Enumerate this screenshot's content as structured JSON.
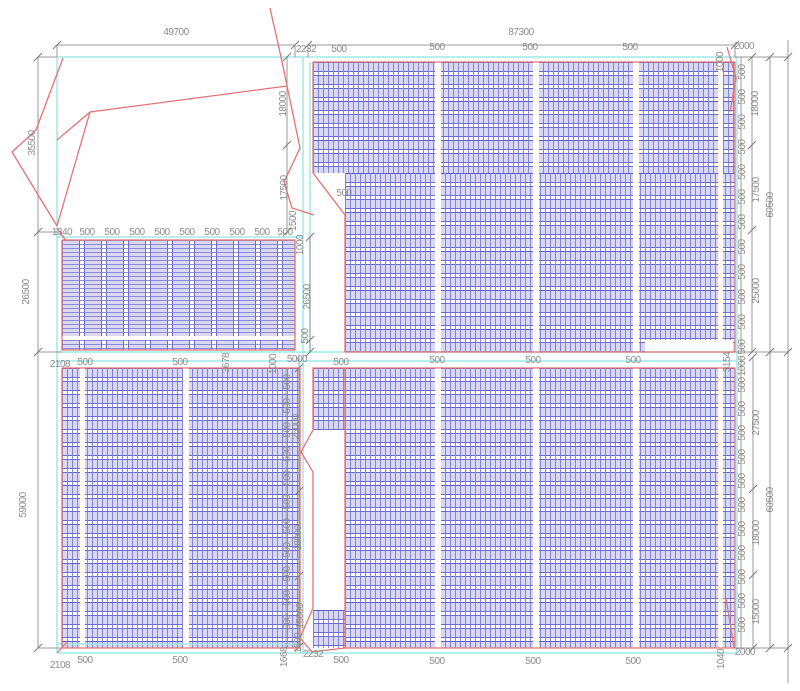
{
  "drawing": {
    "type": "cad-site-plan",
    "width": 800,
    "height": 691,
    "colors": {
      "panel_stripe": "#7676d2",
      "panel_fill": "#a8a8e5",
      "panel_line": "#6b6bce",
      "outline_red": "#e57373",
      "boundary_cyan": "#9fe8e8",
      "dimension_gray": "#9a9a9a",
      "tick_gray": "#7a7a7a",
      "label_gray": "#8c8c8c"
    },
    "blocks": [
      {
        "name": "array-top-right-upper",
        "x": 313,
        "y": 62,
        "w": 422,
        "h": 111,
        "pattern": "rows"
      },
      {
        "name": "array-top-right-lower",
        "x": 345,
        "y": 173,
        "w": 390,
        "h": 179,
        "pattern": "rows"
      },
      {
        "name": "array-mid-left",
        "x": 62,
        "y": 240,
        "w": 233,
        "h": 110,
        "pattern": "cols"
      },
      {
        "name": "array-bottom-left",
        "x": 62,
        "y": 368,
        "w": 238,
        "h": 280,
        "pattern": "rows"
      },
      {
        "name": "array-bottom-right",
        "x": 345,
        "y": 368,
        "w": 390,
        "h": 280,
        "pattern": "rows"
      },
      {
        "name": "array-bottom-right-left-strip-top",
        "x": 313,
        "y": 368,
        "w": 32,
        "h": 62,
        "pattern": "rows"
      },
      {
        "name": "array-bottom-right-left-strip-bottom",
        "x": 313,
        "y": 610,
        "w": 32,
        "h": 38,
        "pattern": "rows"
      }
    ],
    "white_patches": [
      {
        "x": 435,
        "y": 62,
        "w": 6,
        "h": 290
      },
      {
        "x": 533,
        "y": 62,
        "w": 6,
        "h": 290
      },
      {
        "x": 633,
        "y": 62,
        "w": 6,
        "h": 290
      },
      {
        "x": 718,
        "y": 62,
        "w": 5,
        "h": 290
      },
      {
        "x": 645,
        "y": 340,
        "w": 88,
        "h": 12
      },
      {
        "x": 62,
        "y": 336,
        "w": 233,
        "h": 4
      },
      {
        "x": 80,
        "y": 368,
        "w": 5,
        "h": 280
      },
      {
        "x": 183,
        "y": 368,
        "w": 6,
        "h": 280
      },
      {
        "x": 435,
        "y": 368,
        "w": 6,
        "h": 280
      },
      {
        "x": 533,
        "y": 368,
        "w": 6,
        "h": 280
      },
      {
        "x": 633,
        "y": 368,
        "w": 6,
        "h": 280
      },
      {
        "x": 718,
        "y": 368,
        "w": 5,
        "h": 280
      }
    ],
    "red_polylines": [
      [
        [
          313,
          62
        ],
        [
          735,
          62
        ],
        [
          735,
          352
        ],
        [
          345,
          352
        ],
        [
          345,
          215
        ],
        [
          313,
          173
        ],
        [
          313,
          62
        ]
      ],
      [
        [
          62,
          240
        ],
        [
          295,
          240
        ],
        [
          295,
          350
        ],
        [
          62,
          350
        ],
        [
          62,
          240
        ]
      ],
      [
        [
          62,
          368
        ],
        [
          300,
          368
        ],
        [
          300,
          648
        ],
        [
          62,
          648
        ],
        [
          62,
          368
        ]
      ],
      [
        [
          345,
          368
        ],
        [
          735,
          368
        ],
        [
          735,
          648
        ],
        [
          345,
          648
        ],
        [
          345,
          368
        ]
      ],
      [
        [
          345,
          368
        ],
        [
          313,
          368
        ],
        [
          313,
          430
        ],
        [
          301,
          452
        ],
        [
          313,
          472
        ],
        [
          313,
          608
        ],
        [
          300,
          638
        ],
        [
          312,
          652
        ],
        [
          345,
          648
        ]
      ],
      [
        [
          63,
          58
        ],
        [
          36,
          130
        ],
        [
          12,
          152
        ],
        [
          57,
          226
        ]
      ],
      [
        [
          287,
          86
        ],
        [
          90,
          112
        ],
        [
          57,
          140
        ]
      ],
      [
        [
          90,
          112
        ],
        [
          57,
          226
        ]
      ],
      [
        [
          270,
          8
        ],
        [
          281,
          57
        ],
        [
          300,
          148
        ],
        [
          284,
          182
        ],
        [
          292,
          208
        ],
        [
          314,
          215
        ]
      ],
      [
        [
          727,
          47
        ],
        [
          736,
          78
        ],
        [
          730,
          112
        ]
      ],
      [
        [
          726,
          598
        ],
        [
          734,
          648
        ]
      ],
      [
        [
          57,
          228
        ],
        [
          66,
          241
        ]
      ],
      [
        [
          57,
          653
        ],
        [
          67,
          642
        ]
      ]
    ],
    "cyan_lines": [
      [
        57,
        57,
        737,
        57
      ],
      [
        57,
        653,
        737,
        653
      ],
      [
        57,
        57,
        57,
        653
      ],
      [
        737,
        57,
        737,
        653
      ],
      [
        303,
        57,
        303,
        653
      ],
      [
        310,
        62,
        310,
        352
      ],
      [
        57,
        237,
        303,
        237
      ],
      [
        57,
        352,
        737,
        352
      ],
      [
        57,
        361,
        737,
        361
      ],
      [
        57,
        644,
        303,
        644
      ]
    ],
    "dim_lines": [
      [
        57,
        45,
        295,
        45
      ],
      [
        308,
        45,
        735,
        45
      ],
      [
        38,
        57,
        38,
        648
      ],
      [
        287,
        57,
        287,
        232
      ],
      [
        310,
        237,
        310,
        352
      ],
      [
        286,
        368,
        286,
        648
      ],
      [
        299,
        357,
        299,
        648
      ],
      [
        741,
        57,
        741,
        352
      ],
      [
        741,
        357,
        741,
        648
      ],
      [
        752,
        57,
        752,
        352
      ],
      [
        753,
        357,
        753,
        648
      ],
      [
        770,
        57,
        770,
        648
      ],
      [
        788,
        40,
        788,
        683
      ],
      [
        57,
        45,
        57,
        57
      ],
      [
        295,
        45,
        295,
        57
      ],
      [
        308,
        45,
        308,
        57
      ],
      [
        735,
        45,
        735,
        57
      ],
      [
        38,
        57,
        57,
        57
      ],
      [
        38,
        232,
        62,
        232
      ],
      [
        38,
        352,
        62,
        352
      ],
      [
        38,
        648,
        62,
        648
      ],
      [
        735,
        57,
        788,
        57
      ],
      [
        735,
        352,
        788,
        352
      ],
      [
        735,
        648,
        788,
        648
      ]
    ],
    "ticks": [
      [
        57,
        45
      ],
      [
        295,
        45
      ],
      [
        308,
        45
      ],
      [
        735,
        45
      ],
      [
        38,
        57
      ],
      [
        38,
        232
      ],
      [
        38,
        352
      ],
      [
        38,
        648
      ],
      [
        287,
        57
      ],
      [
        287,
        145
      ],
      [
        287,
        232
      ],
      [
        310,
        237
      ],
      [
        310,
        340
      ],
      [
        310,
        352
      ],
      [
        299,
        368
      ],
      [
        299,
        491
      ],
      [
        299,
        576
      ],
      [
        299,
        647
      ],
      [
        752,
        57
      ],
      [
        752,
        145
      ],
      [
        752,
        230
      ],
      [
        752,
        352
      ],
      [
        753,
        357
      ],
      [
        753,
        489
      ],
      [
        753,
        575
      ],
      [
        753,
        648
      ],
      [
        770,
        57
      ],
      [
        770,
        352
      ],
      [
        770,
        648
      ],
      [
        788,
        57
      ],
      [
        788,
        352
      ],
      [
        788,
        648
      ]
    ],
    "labels": [
      {
        "t": "49700",
        "x": 176,
        "y": 33
      },
      {
        "t": "87300",
        "x": 521,
        "y": 33
      },
      {
        "t": "2232",
        "x": 306,
        "y": 50
      },
      {
        "t": "500",
        "x": 339,
        "y": 50
      },
      {
        "t": "500",
        "x": 437,
        "y": 48
      },
      {
        "t": "500",
        "x": 530,
        "y": 48
      },
      {
        "t": "500",
        "x": 630,
        "y": 48
      },
      {
        "t": "1000",
        "x": 721,
        "y": 62,
        "r": 1
      },
      {
        "t": "2000",
        "x": 744,
        "y": 47
      },
      {
        "t": "18000",
        "x": 756,
        "y": 104,
        "r": 1
      },
      {
        "t": "17500",
        "x": 757,
        "y": 190,
        "r": 1
      },
      {
        "t": "25000",
        "x": 757,
        "y": 291,
        "r": 1
      },
      {
        "t": "60500",
        "x": 771,
        "y": 205,
        "r": 1
      },
      {
        "t": "500",
        "x": 743,
        "y": 72,
        "r": 1
      },
      {
        "t": "500",
        "x": 743,
        "y": 97,
        "r": 1
      },
      {
        "t": "500",
        "x": 743,
        "y": 122,
        "r": 1
      },
      {
        "t": "500",
        "x": 743,
        "y": 147,
        "r": 1
      },
      {
        "t": "500",
        "x": 743,
        "y": 172,
        "r": 1
      },
      {
        "t": "500",
        "x": 743,
        "y": 197,
        "r": 1
      },
      {
        "t": "500",
        "x": 743,
        "y": 222,
        "r": 1
      },
      {
        "t": "500",
        "x": 743,
        "y": 247,
        "r": 1
      },
      {
        "t": "500",
        "x": 743,
        "y": 272,
        "r": 1
      },
      {
        "t": "500",
        "x": 743,
        "y": 297,
        "r": 1
      },
      {
        "t": "500",
        "x": 743,
        "y": 322,
        "r": 1
      },
      {
        "t": "500",
        "x": 743,
        "y": 347,
        "r": 1
      },
      {
        "t": "1000",
        "x": 743,
        "y": 366,
        "r": 1
      },
      {
        "t": "500",
        "x": 743,
        "y": 385,
        "r": 1
      },
      {
        "t": "500",
        "x": 743,
        "y": 409,
        "r": 1
      },
      {
        "t": "500",
        "x": 743,
        "y": 433,
        "r": 1
      },
      {
        "t": "500",
        "x": 743,
        "y": 457,
        "r": 1
      },
      {
        "t": "500",
        "x": 743,
        "y": 481,
        "r": 1
      },
      {
        "t": "500",
        "x": 743,
        "y": 505,
        "r": 1
      },
      {
        "t": "500",
        "x": 743,
        "y": 529,
        "r": 1
      },
      {
        "t": "500",
        "x": 743,
        "y": 553,
        "r": 1
      },
      {
        "t": "500",
        "x": 743,
        "y": 577,
        "r": 1
      },
      {
        "t": "500",
        "x": 743,
        "y": 601,
        "r": 1
      },
      {
        "t": "500",
        "x": 743,
        "y": 625,
        "r": 1
      },
      {
        "t": "27500",
        "x": 757,
        "y": 423,
        "r": 1
      },
      {
        "t": "18000",
        "x": 757,
        "y": 533,
        "r": 1
      },
      {
        "t": "15000",
        "x": 757,
        "y": 612,
        "r": 1
      },
      {
        "t": "60500",
        "x": 771,
        "y": 500,
        "r": 1
      },
      {
        "t": "18000",
        "x": 284,
        "y": 104,
        "r": 1
      },
      {
        "t": "17500",
        "x": 285,
        "y": 188,
        "r": 1
      },
      {
        "t": "1500",
        "x": 294,
        "y": 221,
        "r": 1
      },
      {
        "t": "1000",
        "x": 301,
        "y": 245,
        "r": 1
      },
      {
        "t": "26500",
        "x": 308,
        "y": 297,
        "r": 1
      },
      {
        "t": "500",
        "x": 306,
        "y": 336,
        "r": 1
      },
      {
        "t": "500",
        "x": 344,
        "y": 194
      },
      {
        "t": "1340",
        "x": 62,
        "y": 233
      },
      {
        "t": "500",
        "x": 87,
        "y": 233
      },
      {
        "t": "500",
        "x": 112,
        "y": 233
      },
      {
        "t": "500",
        "x": 137,
        "y": 233
      },
      {
        "t": "500",
        "x": 162,
        "y": 233
      },
      {
        "t": "500",
        "x": 187,
        "y": 233
      },
      {
        "t": "500",
        "x": 212,
        "y": 233
      },
      {
        "t": "500",
        "x": 237,
        "y": 233
      },
      {
        "t": "500",
        "x": 262,
        "y": 233
      },
      {
        "t": "500",
        "x": 285,
        "y": 233
      },
      {
        "t": "26500",
        "x": 27,
        "y": 292,
        "r": 1
      },
      {
        "t": "35500",
        "x": 33,
        "y": 143,
        "r": 1
      },
      {
        "t": "59000",
        "x": 24,
        "y": 505,
        "r": 1
      },
      {
        "t": "2108",
        "x": 60,
        "y": 365
      },
      {
        "t": "500",
        "x": 85,
        "y": 363
      },
      {
        "t": "500",
        "x": 180,
        "y": 363
      },
      {
        "t": "3678",
        "x": 227,
        "y": 363,
        "r": 1
      },
      {
        "t": "1000",
        "x": 274,
        "y": 364,
        "r": 1
      },
      {
        "t": "5000",
        "x": 297,
        "y": 360
      },
      {
        "t": "500",
        "x": 341,
        "y": 363
      },
      {
        "t": "500",
        "x": 437,
        "y": 361
      },
      {
        "t": "500",
        "x": 533,
        "y": 361
      },
      {
        "t": "500",
        "x": 633,
        "y": 361
      },
      {
        "t": "3154",
        "x": 728,
        "y": 362,
        "r": 1
      },
      {
        "t": "26000",
        "x": 297,
        "y": 427,
        "r": 1
      },
      {
        "t": "18000",
        "x": 299,
        "y": 538,
        "r": 1
      },
      {
        "t": "15000",
        "x": 301,
        "y": 616,
        "r": 1
      },
      {
        "t": "500",
        "x": 288,
        "y": 382,
        "r": 1
      },
      {
        "t": "500",
        "x": 288,
        "y": 406,
        "r": 1
      },
      {
        "t": "500",
        "x": 288,
        "y": 430,
        "r": 1
      },
      {
        "t": "500",
        "x": 288,
        "y": 454,
        "r": 1
      },
      {
        "t": "500",
        "x": 288,
        "y": 478,
        "r": 1
      },
      {
        "t": "500",
        "x": 288,
        "y": 502,
        "r": 1
      },
      {
        "t": "500",
        "x": 288,
        "y": 526,
        "r": 1
      },
      {
        "t": "500",
        "x": 288,
        "y": 550,
        "r": 1
      },
      {
        "t": "500",
        "x": 288,
        "y": 574,
        "r": 1
      },
      {
        "t": "500",
        "x": 288,
        "y": 598,
        "r": 1
      },
      {
        "t": "500",
        "x": 288,
        "y": 622,
        "r": 1
      },
      {
        "t": "2108",
        "x": 60,
        "y": 666
      },
      {
        "t": "500",
        "x": 85,
        "y": 661
      },
      {
        "t": "500",
        "x": 180,
        "y": 661
      },
      {
        "t": "1668",
        "x": 285,
        "y": 657,
        "r": 1
      },
      {
        "t": "1500",
        "x": 299,
        "y": 643,
        "r": 1
      },
      {
        "t": "2232",
        "x": 313,
        "y": 655
      },
      {
        "t": "500",
        "x": 341,
        "y": 661
      },
      {
        "t": "500",
        "x": 437,
        "y": 662
      },
      {
        "t": "500",
        "x": 533,
        "y": 662
      },
      {
        "t": "500",
        "x": 633,
        "y": 662
      },
      {
        "t": "1040",
        "x": 722,
        "y": 659,
        "r": 1
      },
      {
        "t": "2000",
        "x": 745,
        "y": 653
      }
    ]
  }
}
